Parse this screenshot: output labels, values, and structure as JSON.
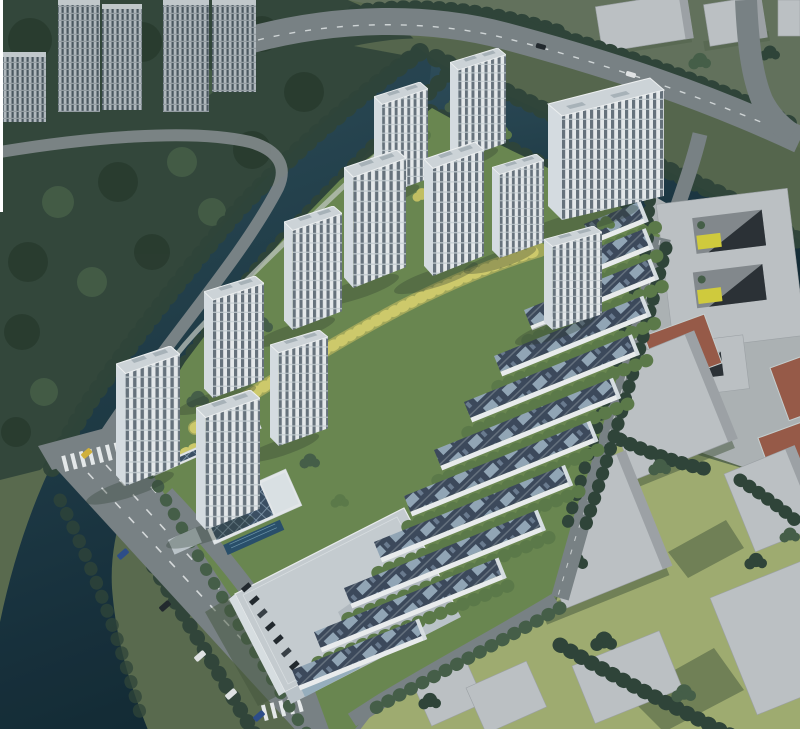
{
  "palette": {
    "water": "#2f4f5c",
    "waterDeep": "#132b36",
    "forest": "#35493c",
    "forestDeep": "#293b2f",
    "treeDark": "#31463a",
    "treeMid": "#48614a",
    "treeBright": "#5f7d4b",
    "treeYellow": "#c9c565",
    "treeYellowLight": "#d6d06e",
    "stripYellow": "#a8ad5c",
    "lawnMuted": "#5c6d50",
    "siteGreen": "#6d8a52",
    "lawnYellow": "#a5b173",
    "shadowOlive": "#45583e",
    "northGround": "#66755f",
    "medianGreen": "#58694f",
    "road": "#7d8588",
    "roadMinor": "#878e90",
    "pathLight": "#c6ccc6",
    "laneMark": "#eef1f2",
    "wallWhite": "#eef1f3",
    "winBand": "#5c6873",
    "roofLight": "#d5dbdf",
    "sideLight": "#dde3e8",
    "roofDark": "#3e4b5e",
    "panelLight": "#9fb3c5",
    "massing": "#c3c7ca",
    "massingShade": "#a2a7ab",
    "plaza": "#b2b7b9",
    "courtRed": "#9c5c4a",
    "poolBlue": "#2a516d",
    "solarDark": "#3d5166",
    "solarLine": "#8ea5b9",
    "carBlue": "#2f4f8e",
    "carDark": "#23292f",
    "carWhite": "#e9ebec",
    "carYellow": "#d9b63c",
    "bgWall": "#b7bfc4",
    "bgBand": "#4e5a63",
    "frame": "#ffffff"
  },
  "scene": {
    "site": {
      "residential_towers": 12,
      "townhouse_rows": 11,
      "clubhouse": 1,
      "swimming_pool": 1,
      "solar_canopy": 1,
      "commercial_building": 1
    },
    "context": {
      "background_towers": 5,
      "massing_blocks": 11,
      "courtyard_building": 1,
      "sports_courts": 3
    },
    "waterways": {
      "canals": 2
    },
    "roads": {
      "major_roads": 2,
      "minor_streets": 5,
      "crosswalks": 2,
      "bridges": 2
    },
    "vehicles": {
      "moving_cars": 8,
      "parked_cars": 12
    }
  }
}
